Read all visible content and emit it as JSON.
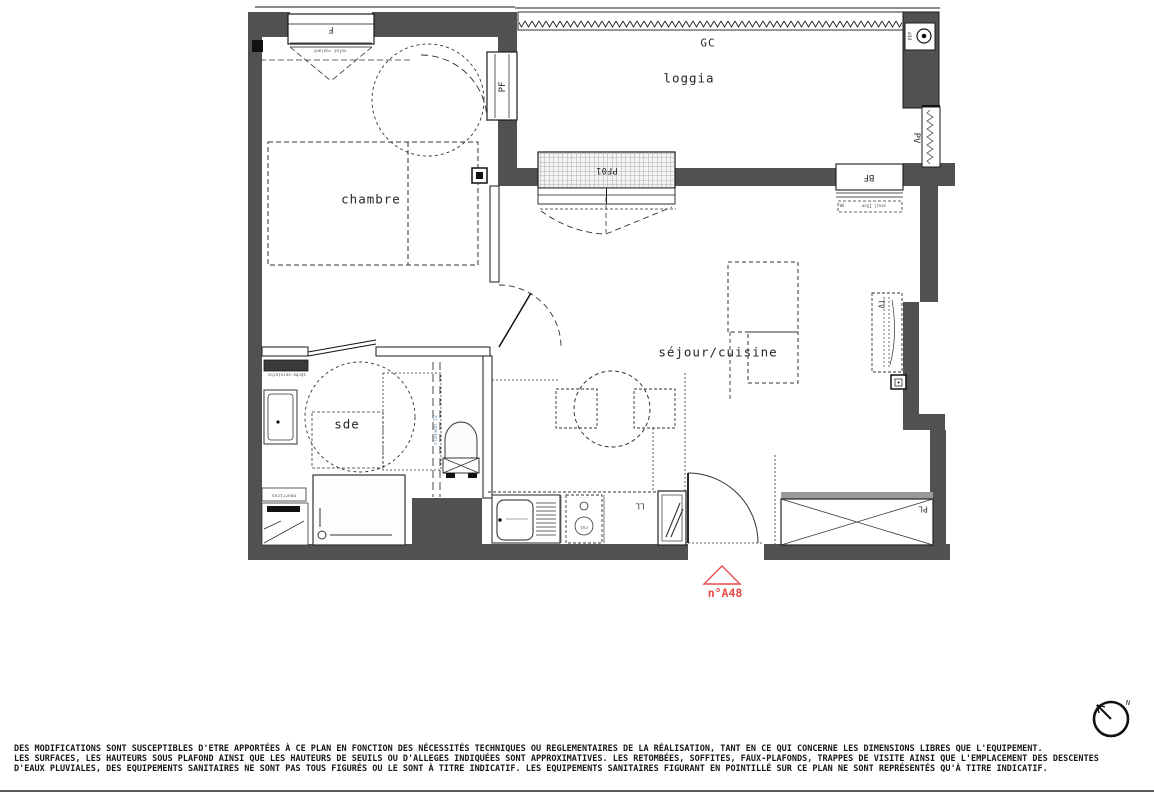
{
  "plan": {
    "rooms": {
      "chambre": "chambre",
      "loggia": "loggia",
      "sejour_cuisine": "séjour/cuisine",
      "sde": "sde"
    },
    "marks": {
      "f": "F",
      "pf": "PF",
      "gc": "GC",
      "dep": "DEP",
      "pv": "PV",
      "pf01": "PF01",
      "bf": "BF",
      "vr": "VR",
      "seuil": "seuil 15cm",
      "volet": "volet roulant",
      "cloison": "cloison 72",
      "seche_serviette": "sèche-serviette",
      "nourrices": "nourrices",
      "cui": "cui",
      "ll": "LL",
      "pl": "PL",
      "tv": "TV"
    },
    "unit_number": "n°A48",
    "compass_north": "N",
    "colors": {
      "wall": "#515151",
      "line": "#1a1a1a",
      "accent_red": "#e84b4b",
      "annotation_blue": "#5b7ea8"
    }
  },
  "footer": {
    "line1": "DES MODIFICATIONS SONT SUSCEPTIBLES D'ETRE APPORTÉES À CE PLAN EN FONCTION DES NÉCESSITÉS TECHNIQUES OU REGLEMENTAIRES DE LA RÉALISATION, TANT EN CE QUI CONCERNE LES DIMENSIONS LIBRES QUE L'EQUIPEMENT.",
    "line2": "LES SURFACES, LES HAUTEURS SOUS PLAFOND AINSI QUE LES HAUTEURS DE SEUILS OU D'ALLEGES INDIQUÉES SONT APPROXIMATIVES. LES RETOMBÉES, SOFFITES, FAUX-PLAFONDS, TRAPPES DE VISITE AINSI QUE L'EMPLACEMENT DES DESCENTES",
    "line3": "D'EAUX PLUVIALES, DES EQUIPEMENTS SANITAIRES NE SONT PAS TOUS FIGURÉS OU LE SONT À TITRE INDICATIF. LES EQUIPEMENTS SANITAIRES FIGURANT EN POINTILLÉ SUR CE PLAN NE SONT REPRÉSENTÉS QU'À TITRE INDICATIF."
  }
}
